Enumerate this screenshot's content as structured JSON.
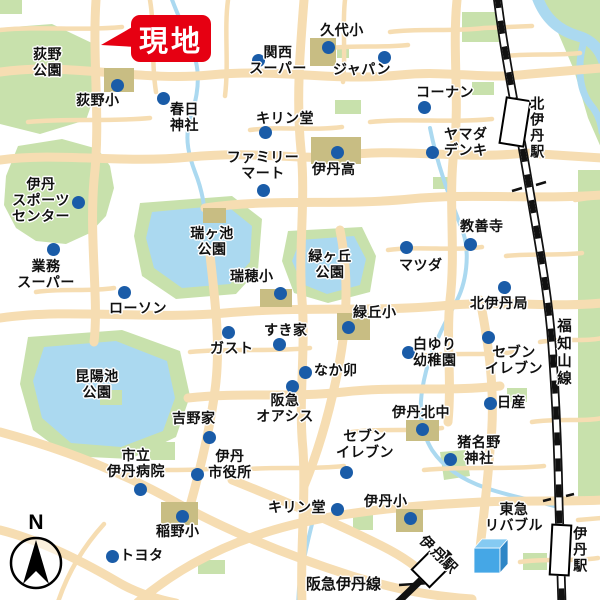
{
  "colors": {
    "road": "#f6ddb2",
    "park": "#c8e1ac",
    "water": "#abd9f0",
    "school": "#c8bd83",
    "dot": "#1a5ca8",
    "site": "#e60012",
    "rail": "#111111",
    "cube_front": "#45a7e6",
    "cube_top": "#85caf2",
    "cube_side": "#2e86c6"
  },
  "site_callout": {
    "label": "現地"
  },
  "compass": {
    "label": "N"
  },
  "rail": {
    "fukuchiyama": {
      "label": "福知山線"
    },
    "hankyu_line": {
      "label": "阪急伊丹線"
    }
  },
  "stations": [
    {
      "id": "kita-itami-station",
      "label": "北伊丹駅",
      "rect": [
        502,
        98,
        26,
        48
      ],
      "rot": 9,
      "label_pos": [
        529,
        96
      ],
      "label_mode": "vertical"
    },
    {
      "id": "itami-station-jr",
      "label": "伊丹駅",
      "rect": [
        550,
        524,
        21,
        52
      ],
      "rot": 3,
      "label_pos": [
        572,
        526
      ],
      "label_mode": "vertical"
    },
    {
      "id": "itami-station-hankyu",
      "label": "伊丹駅",
      "rect": [
        416,
        556,
        27,
        27
      ],
      "rot": 45,
      "label_pos": [
        428,
        532
      ],
      "label_mode": "diag"
    }
  ],
  "park_labels": [
    {
      "id": "ogino-park",
      "label": "荻野\n公園",
      "x": 33,
      "y": 46,
      "align": "left"
    },
    {
      "id": "zugaike-park",
      "label": "瑞ヶ池\n公園",
      "x": 212,
      "y": 225,
      "align": "center"
    },
    {
      "id": "midorigaoka-park",
      "label": "緑ヶ丘\n公園",
      "x": 330,
      "y": 248,
      "align": "center"
    },
    {
      "id": "koyaike-park",
      "label": "昆陽池\n公園",
      "x": 97,
      "y": 368,
      "align": "center"
    }
  ],
  "pois": [
    {
      "id": "ogino-es",
      "label": "荻野小",
      "x": 76,
      "y": 92,
      "align": "left",
      "dot": [
        117,
        85
      ]
    },
    {
      "id": "kasuga-shrine",
      "label": "春日\n神社",
      "x": 170,
      "y": 101,
      "align": "left",
      "dot": [
        163,
        98
      ]
    },
    {
      "id": "kansai-super",
      "label": "関西\nスーパー",
      "x": 278,
      "y": 44,
      "align": "center",
      "dot": [
        258,
        60
      ]
    },
    {
      "id": "kushiro-es",
      "label": "久代小",
      "x": 342,
      "y": 22,
      "align": "center",
      "dot": [
        328,
        47
      ]
    },
    {
      "id": "japan-store",
      "label": "ジャパン",
      "x": 333,
      "y": 61,
      "align": "left",
      "dot": [
        384,
        57
      ]
    },
    {
      "id": "kirindo-north",
      "label": "キリン堂",
      "x": 256,
      "y": 110,
      "align": "left",
      "dot": [
        265,
        132
      ]
    },
    {
      "id": "kohnan",
      "label": "コーナン",
      "x": 416,
      "y": 84,
      "align": "left",
      "dot": [
        424,
        107
      ]
    },
    {
      "id": "yamada-denki",
      "label": "ヤマダ\nデンキ",
      "x": 444,
      "y": 126,
      "align": "left",
      "dot": [
        432,
        152
      ]
    },
    {
      "id": "family-mart",
      "label": "ファミリー\nマート",
      "x": 263,
      "y": 149,
      "align": "center",
      "dot": [
        263,
        190
      ]
    },
    {
      "id": "itami-hs",
      "label": "伊丹高",
      "x": 312,
      "y": 161,
      "align": "left",
      "dot": [
        337,
        152
      ]
    },
    {
      "id": "itami-sports-center",
      "label": "伊丹\nスポーツ\nセンター",
      "x": 41,
      "y": 176,
      "align": "center",
      "dot": [
        78,
        202
      ]
    },
    {
      "id": "kyozenji",
      "label": "教善寺",
      "x": 460,
      "y": 218,
      "align": "left",
      "dot": [
        470,
        244
      ]
    },
    {
      "id": "mazda",
      "label": "マツダ",
      "x": 399,
      "y": 257,
      "align": "left",
      "dot": [
        406,
        247
      ]
    },
    {
      "id": "gyomu-super",
      "label": "業務\nスーパー",
      "x": 46,
      "y": 258,
      "align": "center",
      "dot": [
        53,
        249
      ]
    },
    {
      "id": "mizuho-es",
      "label": "瑞穂小",
      "x": 230,
      "y": 268,
      "align": "left",
      "dot": [
        280,
        293
      ]
    },
    {
      "id": "kita-itami-post",
      "label": "北伊丹局",
      "x": 470,
      "y": 295,
      "align": "left",
      "dot": [
        504,
        287
      ]
    },
    {
      "id": "lawson",
      "label": "ローソン",
      "x": 109,
      "y": 300,
      "align": "left",
      "dot": [
        124,
        292
      ]
    },
    {
      "id": "midorioka-es",
      "label": "緑丘小",
      "x": 353,
      "y": 304,
      "align": "left",
      "dot": [
        348,
        327
      ]
    },
    {
      "id": "sukiya",
      "label": "すき家",
      "x": 264,
      "y": 322,
      "align": "left",
      "dot": [
        279,
        344
      ]
    },
    {
      "id": "gusto",
      "label": "ガスト",
      "x": 210,
      "y": 340,
      "align": "left",
      "dot": [
        228,
        332
      ]
    },
    {
      "id": "shirayuri-kg",
      "label": "白ゆり\n幼稚園",
      "x": 413,
      "y": 336,
      "align": "left",
      "dot": [
        408,
        352
      ]
    },
    {
      "id": "seven-eleven-ne",
      "label": "セブン\nイレブン",
      "x": 514,
      "y": 344,
      "align": "center",
      "dot": [
        488,
        337
      ]
    },
    {
      "id": "nakau",
      "label": "なか卯",
      "x": 314,
      "y": 362,
      "align": "left",
      "dot": [
        305,
        372
      ]
    },
    {
      "id": "nissan",
      "label": "日産",
      "x": 497,
      "y": 394,
      "align": "left",
      "dot": [
        490,
        403
      ]
    },
    {
      "id": "hankyu-oasis",
      "label": "阪急\nオアシス",
      "x": 285,
      "y": 392,
      "align": "center",
      "dot": [
        292,
        386
      ]
    },
    {
      "id": "itami-kita-jhs",
      "label": "伊丹北中",
      "x": 392,
      "y": 404,
      "align": "left",
      "dot": [
        422,
        429
      ]
    },
    {
      "id": "yoshinoya",
      "label": "吉野家",
      "x": 172,
      "y": 410,
      "align": "left",
      "dot": [
        209,
        437
      ]
    },
    {
      "id": "seven-eleven-s",
      "label": "セブン\nイレブン",
      "x": 365,
      "y": 428,
      "align": "center",
      "dot": [
        346,
        472
      ]
    },
    {
      "id": "inano-shrine",
      "label": "猪名野\n神社",
      "x": 479,
      "y": 434,
      "align": "center",
      "dot": [
        450,
        459
      ]
    },
    {
      "id": "itami-hospital",
      "label": "市立\n伊丹病院",
      "x": 136,
      "y": 447,
      "align": "center",
      "dot": [
        140,
        489
      ]
    },
    {
      "id": "itami-city-hall",
      "label": "伊丹\n市役所",
      "x": 230,
      "y": 448,
      "align": "center",
      "dot": [
        197,
        474
      ]
    },
    {
      "id": "kirindo-south",
      "label": "キリン堂",
      "x": 268,
      "y": 499,
      "align": "left",
      "dot": [
        337,
        509
      ]
    },
    {
      "id": "itami-es",
      "label": "伊丹小",
      "x": 364,
      "y": 493,
      "align": "left",
      "dot": [
        410,
        518
      ]
    },
    {
      "id": "inano-es",
      "label": "稲野小",
      "x": 156,
      "y": 523,
      "align": "left",
      "dot": [
        182,
        516
      ]
    },
    {
      "id": "toyota",
      "label": "トヨタ",
      "x": 120,
      "y": 547,
      "align": "left",
      "dot": [
        112,
        556
      ]
    },
    {
      "id": "tokyu-livable",
      "label": "東急\nリバブル",
      "x": 514,
      "y": 501,
      "align": "center",
      "dot": null
    }
  ]
}
